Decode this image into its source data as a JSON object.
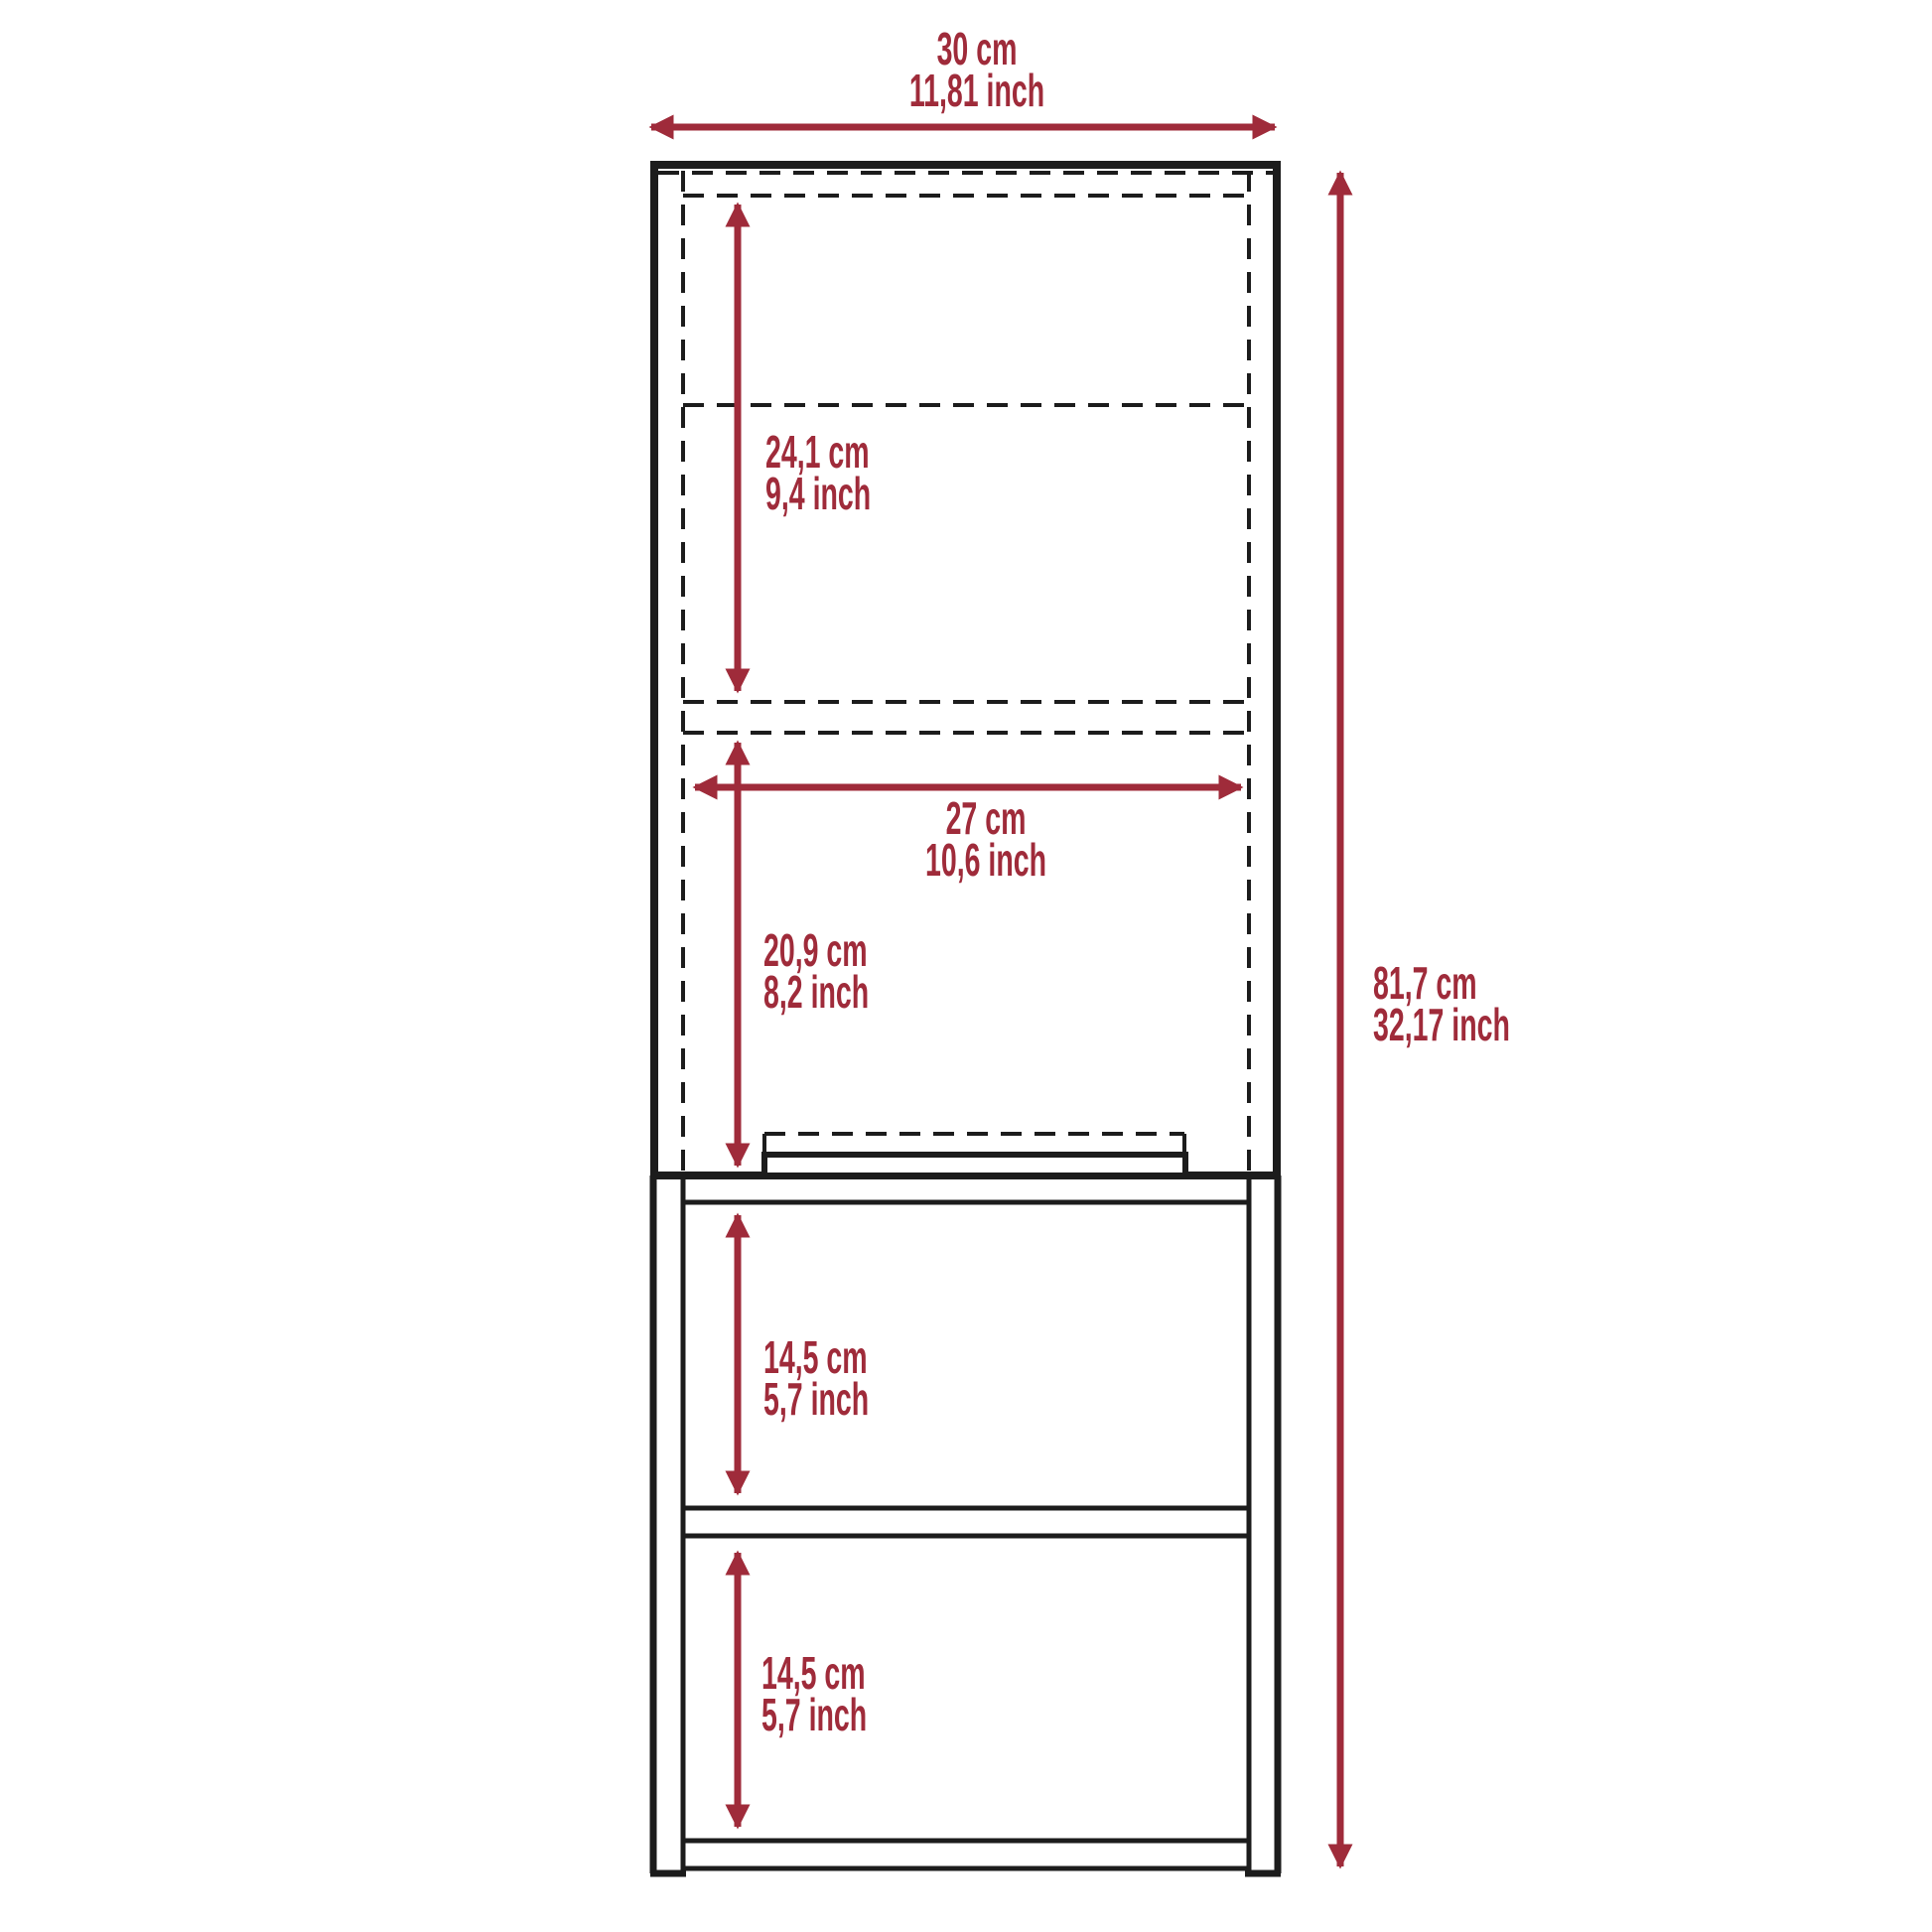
{
  "title": "Cabinet dimension diagram",
  "colors": {
    "background": "#ffffff",
    "line": "#1c1c1c",
    "accent": "#9f2b3a"
  },
  "dimensions": {
    "overall_width": {
      "cm": "30 cm",
      "inch": "11,81 inch"
    },
    "overall_height": {
      "cm": "81,7 cm",
      "inch": "32,17 inch"
    },
    "upper_compartment_height": {
      "cm": "24,1 cm",
      "inch": "9,4 inch"
    },
    "inner_width": {
      "cm": "27 cm",
      "inch": "10,6 inch"
    },
    "door_compartment_height": {
      "cm": "20,9 cm",
      "inch": "8,2 inch"
    },
    "upper_shelf_height": {
      "cm": "14,5 cm",
      "inch": "5,7 inch"
    },
    "lower_shelf_height": {
      "cm": "14,5 cm",
      "inch": "5,7 inch"
    }
  }
}
